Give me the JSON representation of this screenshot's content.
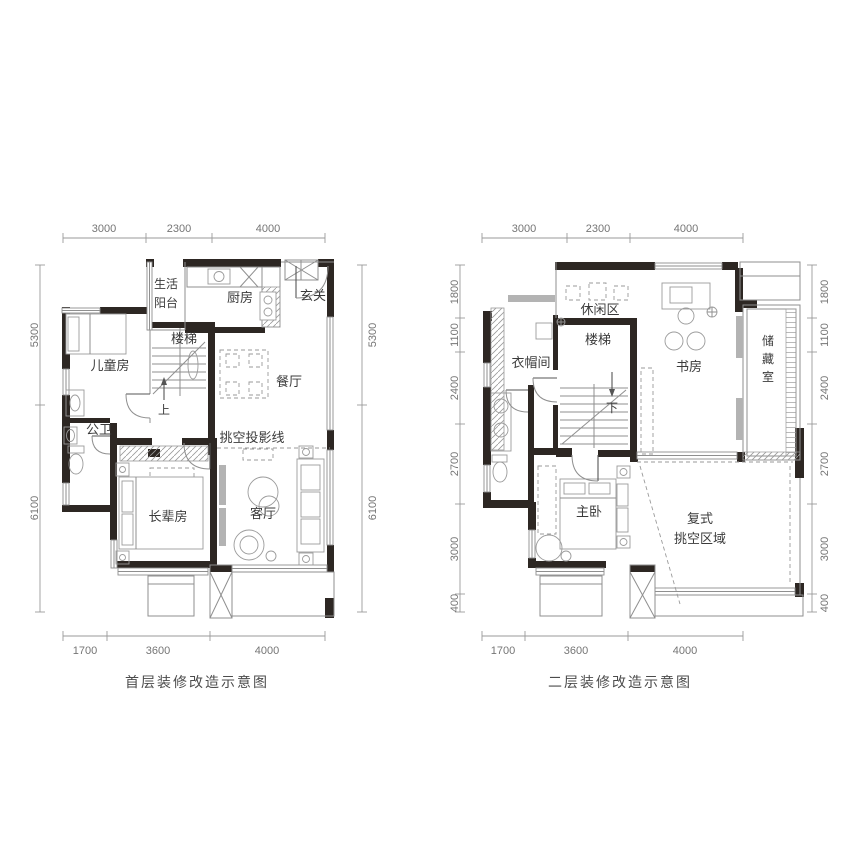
{
  "page": {
    "type": "floor-plan-drawing"
  },
  "floor1": {
    "caption": "首层装修改造示意图",
    "dims": {
      "top": [
        "3000",
        "2300",
        "4000"
      ],
      "left": [
        "5300",
        "6100"
      ],
      "right": [
        "5300",
        "6100"
      ],
      "bottom": [
        "1700",
        "3600",
        "4000"
      ]
    },
    "rooms": {
      "balcony_line1": "生活",
      "balcony_line2": "阳台",
      "kitchen": "厨房",
      "entry": "玄关",
      "stairs": "楼梯",
      "kids_room": "儿童房",
      "dining": "餐厅",
      "bathroom": "公卫",
      "void_projection_line": "挑空投影线",
      "elder_room": "长辈房",
      "living_room": "客厅",
      "stairs_up": "上"
    }
  },
  "floor2": {
    "caption": "二层装修改造示意图",
    "dims": {
      "top": [
        "3000",
        "2300",
        "4000"
      ],
      "left": [
        "1800",
        "1100",
        "2400",
        "2700",
        "3000",
        "400"
      ],
      "right": [
        "1800",
        "1100",
        "2400",
        "2700",
        "3000",
        "400"
      ],
      "bottom": [
        "1700",
        "3600",
        "4000"
      ]
    },
    "rooms": {
      "leisure": "休闲区",
      "cloakroom": "衣帽间",
      "stairs": "楼梯",
      "study": "书房",
      "storage_char1": "储",
      "storage_char2": "藏",
      "storage_char3": "室",
      "master_bedroom": "主卧",
      "void_line1": "复式",
      "void_line2": "挑空区域",
      "stairs_down": "下"
    }
  },
  "colors": {
    "wall": "#2d2723",
    "line": "#8f8f8f",
    "text": "#3b3b3b",
    "dim_text": "#757575"
  }
}
